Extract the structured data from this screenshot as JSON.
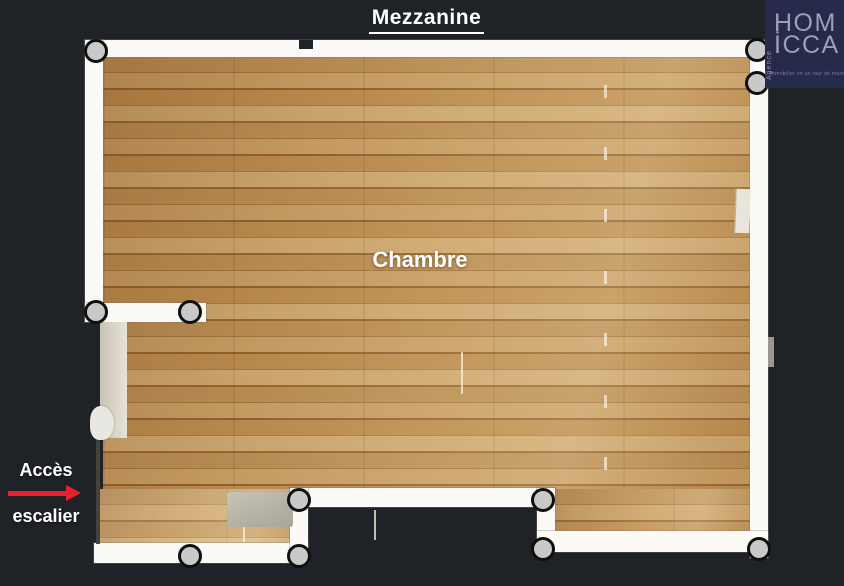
{
  "title": {
    "text": "Mezzanine"
  },
  "logo": {
    "line1": "HOM",
    "line2": "İCCA",
    "vertical_text": "Agence",
    "tagline": "L'immobilier en un tour de main",
    "background_color": "#262b4c",
    "text_color": "#9aa0b8"
  },
  "floorplan": {
    "room_label": "Chambre",
    "access_line1": "Accès",
    "access_line2": "escalier",
    "arrow_color": "#e8212d",
    "wall_color": "#fbfaf7",
    "floor_color": "#b0834a",
    "background_color": "#1f2227",
    "scan_point_color": "#c9c9c9",
    "scan_points": [
      [
        96,
        51
      ],
      [
        757,
        50
      ],
      [
        757,
        83
      ],
      [
        96,
        312
      ],
      [
        190,
        312
      ],
      [
        299,
        500
      ],
      [
        543,
        500
      ],
      [
        190,
        556
      ],
      [
        299,
        556
      ],
      [
        543,
        549
      ],
      [
        759,
        549
      ]
    ]
  }
}
